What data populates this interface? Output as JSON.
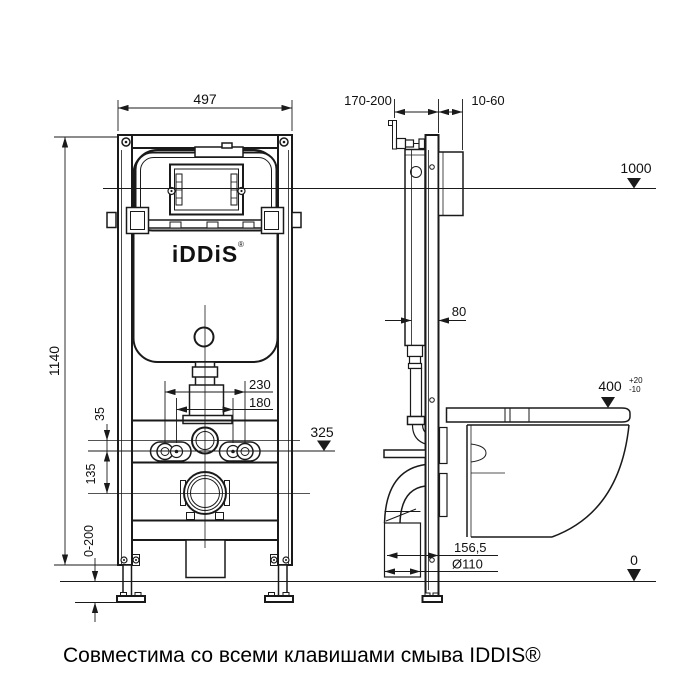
{
  "colors": {
    "line": "#1a1a1a",
    "text": "#111111",
    "background": "#ffffff"
  },
  "caption": "Совместима со всеми клавишами смыва IDDIS®",
  "logo": {
    "text": "iDDiS",
    "mark": "®"
  },
  "front_view": {
    "dims": {
      "frame_width": "497",
      "frame_height": "1140",
      "inlet_to_level": "35",
      "level_to_drain": "135",
      "leg_adjustment": "0-200",
      "anchor_spacing_outer": "230",
      "anchor_spacing_inner": "180"
    },
    "levels": {
      "drain_axis": "325"
    }
  },
  "side_view": {
    "dims": {
      "frame_depth_range": "170-200",
      "wall_clearance": "10-60",
      "profile_depth": "80",
      "outlet_to_wall": "156,5",
      "outlet_diameter": "Ø110"
    },
    "levels": {
      "frame_top": "1000",
      "bowl_top": "400",
      "bowl_top_tol_plus": "+20",
      "bowl_top_tol_minus": "-10",
      "floor": "0"
    }
  }
}
